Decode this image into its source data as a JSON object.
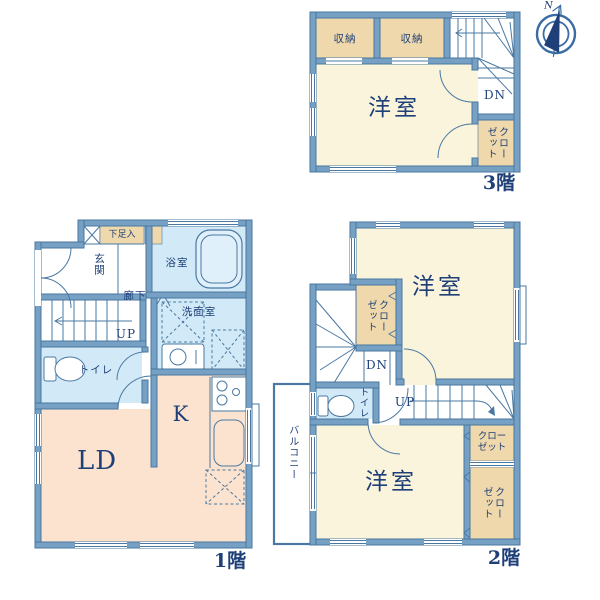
{
  "colors": {
    "wall": "#76a1c5",
    "wall_edge": "#49779f",
    "line": "#4a78a2",
    "text": "#1e3f78",
    "room_cream": "#faf4dc",
    "room_peach": "#fbe3cf",
    "room_blue": "#d2eaf7",
    "room_tan": "#efd8ab",
    "fixture_blue": "#e0f0fa"
  },
  "compass": {
    "north": "N"
  },
  "floor3": {
    "label": "3階",
    "storage_left": "収納",
    "storage_right": "収納",
    "western_room": "洋室",
    "closet": "クローゼット",
    "stairs_down": "DN"
  },
  "floor1": {
    "label": "1階",
    "shoe_cabinet": "下足入",
    "entrance": "玄関",
    "bathroom": "浴室",
    "hallway": "廊下",
    "washroom": "洗面室",
    "toilet": "トイレ",
    "living_dining": "LD",
    "kitchen": "K",
    "stairs_up": "UP"
  },
  "floor2": {
    "label": "2階",
    "western_room_north": "洋室",
    "western_room_south": "洋室",
    "closet_inner": "クローゼット",
    "closet_east_north": "クローゼット",
    "closet_east_south": "クローゼット",
    "toilet": "トイレ",
    "balcony": "バルコニー",
    "stairs_down": "DN",
    "stairs_up": "UP"
  }
}
